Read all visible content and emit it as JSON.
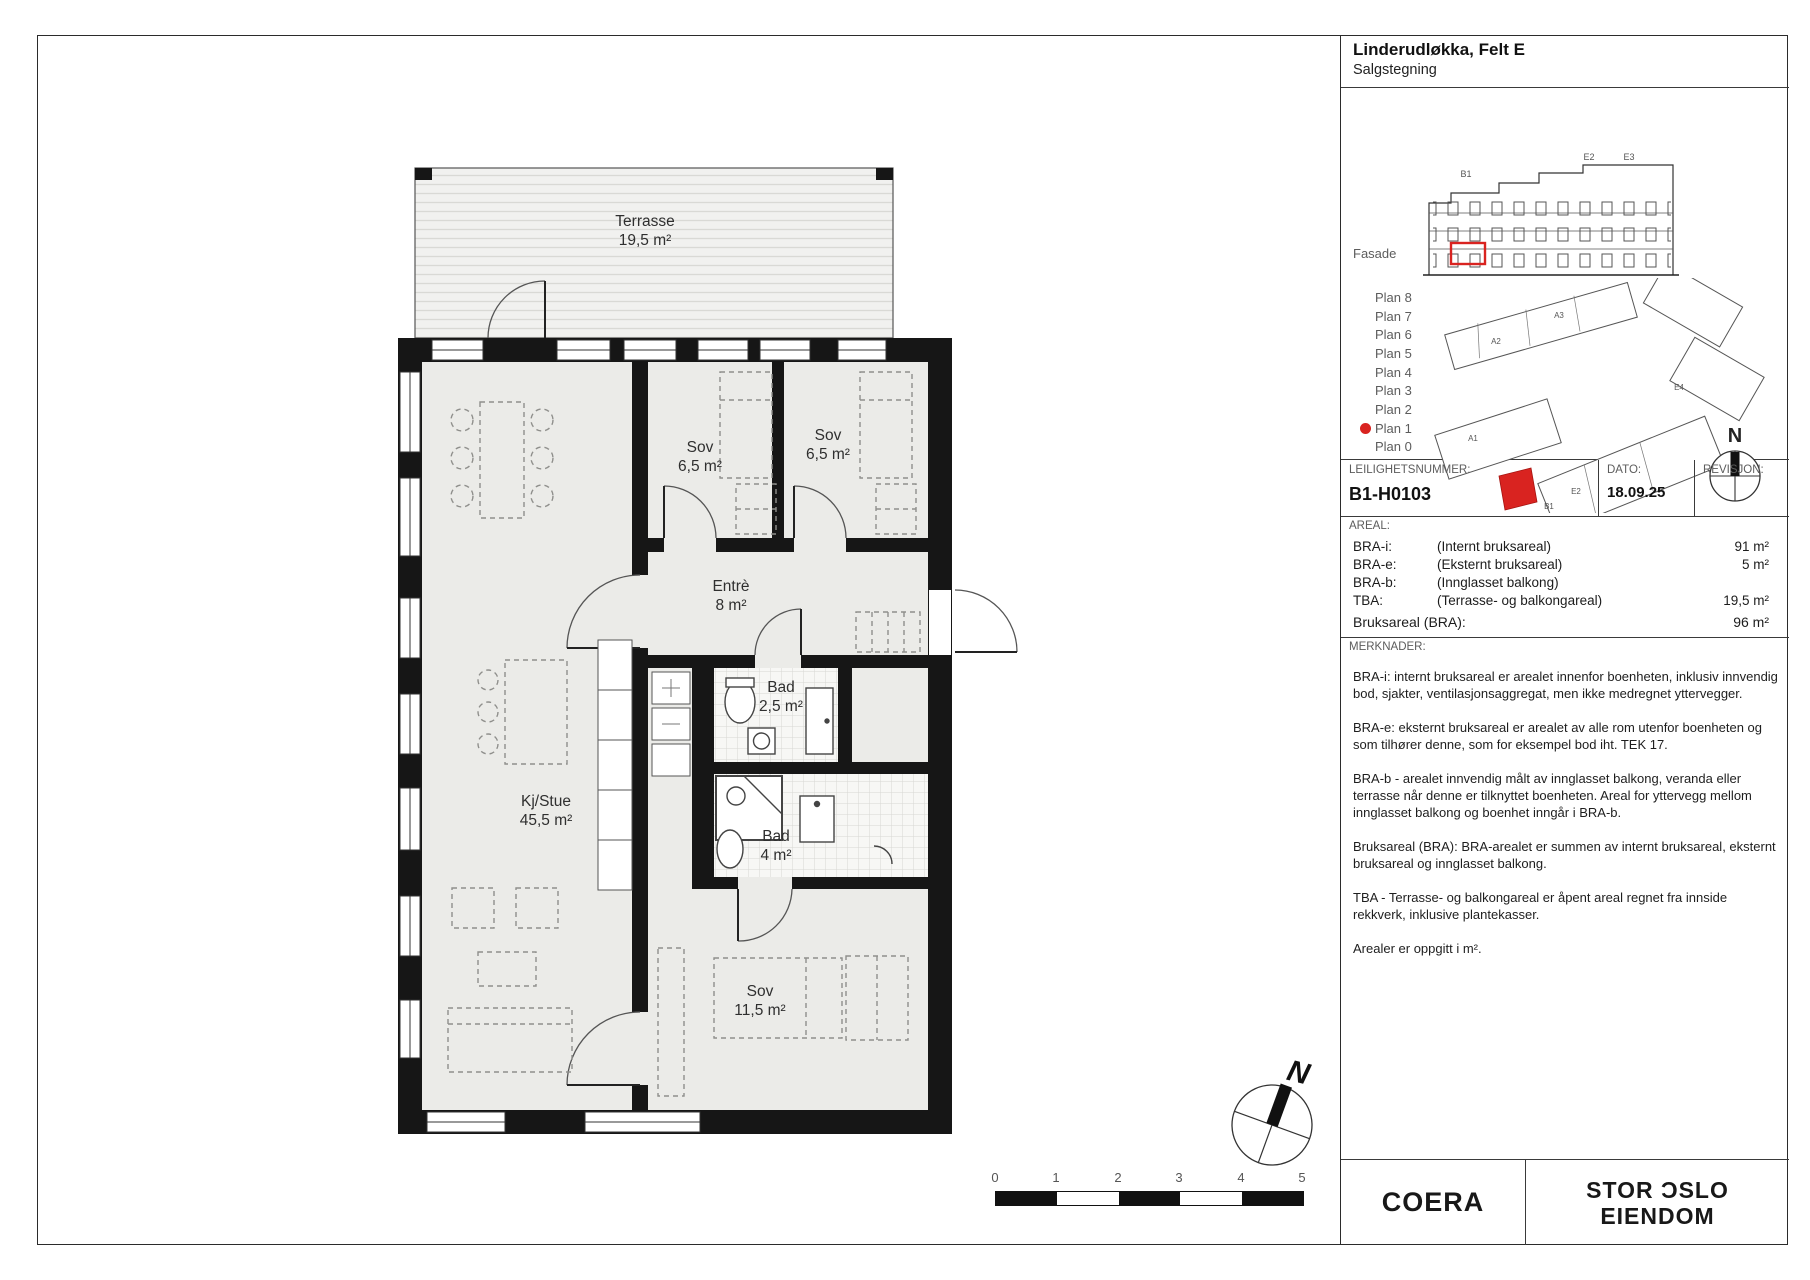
{
  "header": {
    "project_name": "Linderudløkka, Felt E",
    "drawing_type": "Salgstegning"
  },
  "locator": {
    "fasade_label": "Fasade",
    "plans": [
      "Plan 8",
      "Plan 7",
      "Plan 6",
      "Plan 5",
      "Plan 4",
      "Plan 3",
      "Plan 2",
      "Plan 1",
      "Plan 0"
    ],
    "active_plan": "Plan 1",
    "facade_labels": [
      "B1",
      "E2",
      "E3"
    ],
    "site_labels": [
      "A2",
      "A3",
      "A1",
      "E4",
      "B1",
      "E2"
    ]
  },
  "apartment": {
    "number_label": "LEILIGHETSNUMMER:",
    "number_value": "B1-H0103",
    "date_label": "DATO:",
    "date_value": "18.09.25",
    "revision_label": "REVISJON:",
    "revision_value": ""
  },
  "areal": {
    "label": "AREAL:",
    "rows": [
      {
        "code": "BRA-i:",
        "desc": "(Internt bruksareal)",
        "value": "91 m²"
      },
      {
        "code": "BRA-e:",
        "desc": "(Eksternt bruksareal)",
        "value": "5 m²"
      },
      {
        "code": "BRA-b:",
        "desc": "(Innglasset balkong)",
        "value": ""
      },
      {
        "code": "TBA:",
        "desc": "(Terrasse- og balkongareal)",
        "value": "19,5 m²"
      }
    ],
    "total_label": "Bruksareal (BRA):",
    "total_value": "96 m²"
  },
  "merknader": {
    "label": "MERKNADER:",
    "paragraphs": [
      "BRA-i: internt bruksareal er arealet innenfor boenheten, inklusiv innvendig bod, sjakter, ventilasjonsaggregat, men ikke medregnet yttervegger.",
      "BRA-e: eksternt bruksareal er arealet av alle rom utenfor boenheten og som tilhører denne, som for eksempel bod iht. TEK 17.",
      "BRA-b - arealet innvendig målt av innglasset balkong, veranda eller terrasse når denne er tilknyttet boenheten. Areal for yttervegg mellom innglasset balkong og boenhet inngår i BRA-b.",
      "Bruksareal (BRA): BRA-arealet er summen av internt bruksareal, eksternt bruksareal og innglasset balkong.",
      "TBA - Terrasse- og balkongareal er åpent areal regnet fra innside rekkverk, inklusive plantekasser.",
      "Arealer er oppgitt i m²."
    ]
  },
  "rooms": [
    {
      "name": "Terrasse",
      "area": "19,5 m²"
    },
    {
      "name": "Sov",
      "area": "6,5 m²"
    },
    {
      "name": "Sov",
      "area": "6,5 m²"
    },
    {
      "name": "Entrè",
      "area": "8 m²"
    },
    {
      "name": "Bad",
      "area": "2,5 m²"
    },
    {
      "name": "Kj/Stue",
      "area": "45,5 m²"
    },
    {
      "name": "Bad",
      "area": "4 m²"
    },
    {
      "name": "Sov",
      "area": "11,5 m²"
    }
  ],
  "compass": {
    "north_label": "N"
  },
  "scalebar": {
    "ticks": [
      "0",
      "1",
      "2",
      "3",
      "4",
      "5"
    ]
  },
  "logos": {
    "coera": "COERA",
    "stor_oslo_line1": "STOR ƆSLO",
    "stor_oslo_line2": "EIENDOM"
  },
  "colors": {
    "accent_red": "#d92320",
    "wall_black": "#161616",
    "floor_gray": "#ebebe8"
  }
}
